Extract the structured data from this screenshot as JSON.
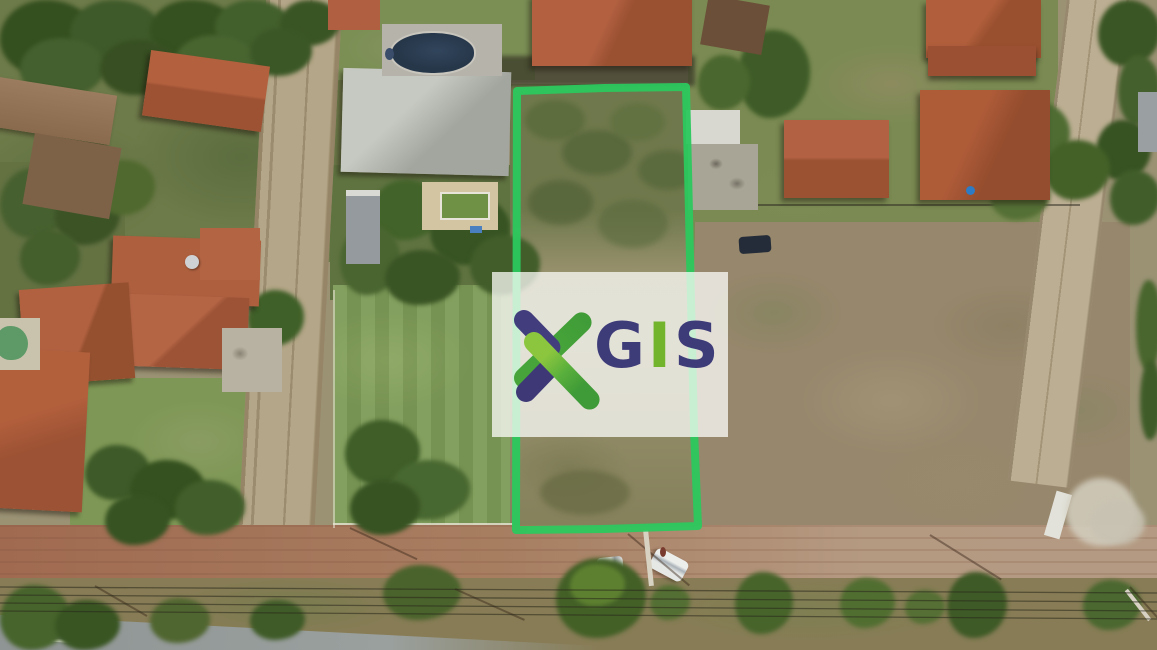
{
  "watermark": {
    "panel_color": "rgba(255,255,255,0.74)",
    "letters": [
      {
        "char": "G",
        "color": "#3e3b79"
      },
      {
        "char": "I",
        "color": "#72b52d"
      },
      {
        "char": "S",
        "color": "#3e3b79"
      }
    ],
    "logo": {
      "navy": "#423d7d",
      "green_dark": "#3f9b37",
      "green_mid": "#49a53b",
      "green_light": "#8cc63f"
    }
  },
  "boundary": {
    "color": "#2cc85e",
    "stroke_width": 8,
    "points": "517,91 604,88 686,87 688,170 691,300 694,430 698,526 603,529 516,530"
  },
  "palette": {
    "roof_terracotta": "#ad5c3a",
    "roof_metal": "#c2c5bd",
    "roof_rust": "#8a6a4d",
    "dirt_road_red": "#a06a50",
    "dirt_road_tan": "#b59a82",
    "asphalt": "#8f9594",
    "grass_lot": "#7d9b57",
    "field_brown": "#97876c",
    "pool_dark": "#2c3d50",
    "pool_teal": "#5d9a67"
  }
}
